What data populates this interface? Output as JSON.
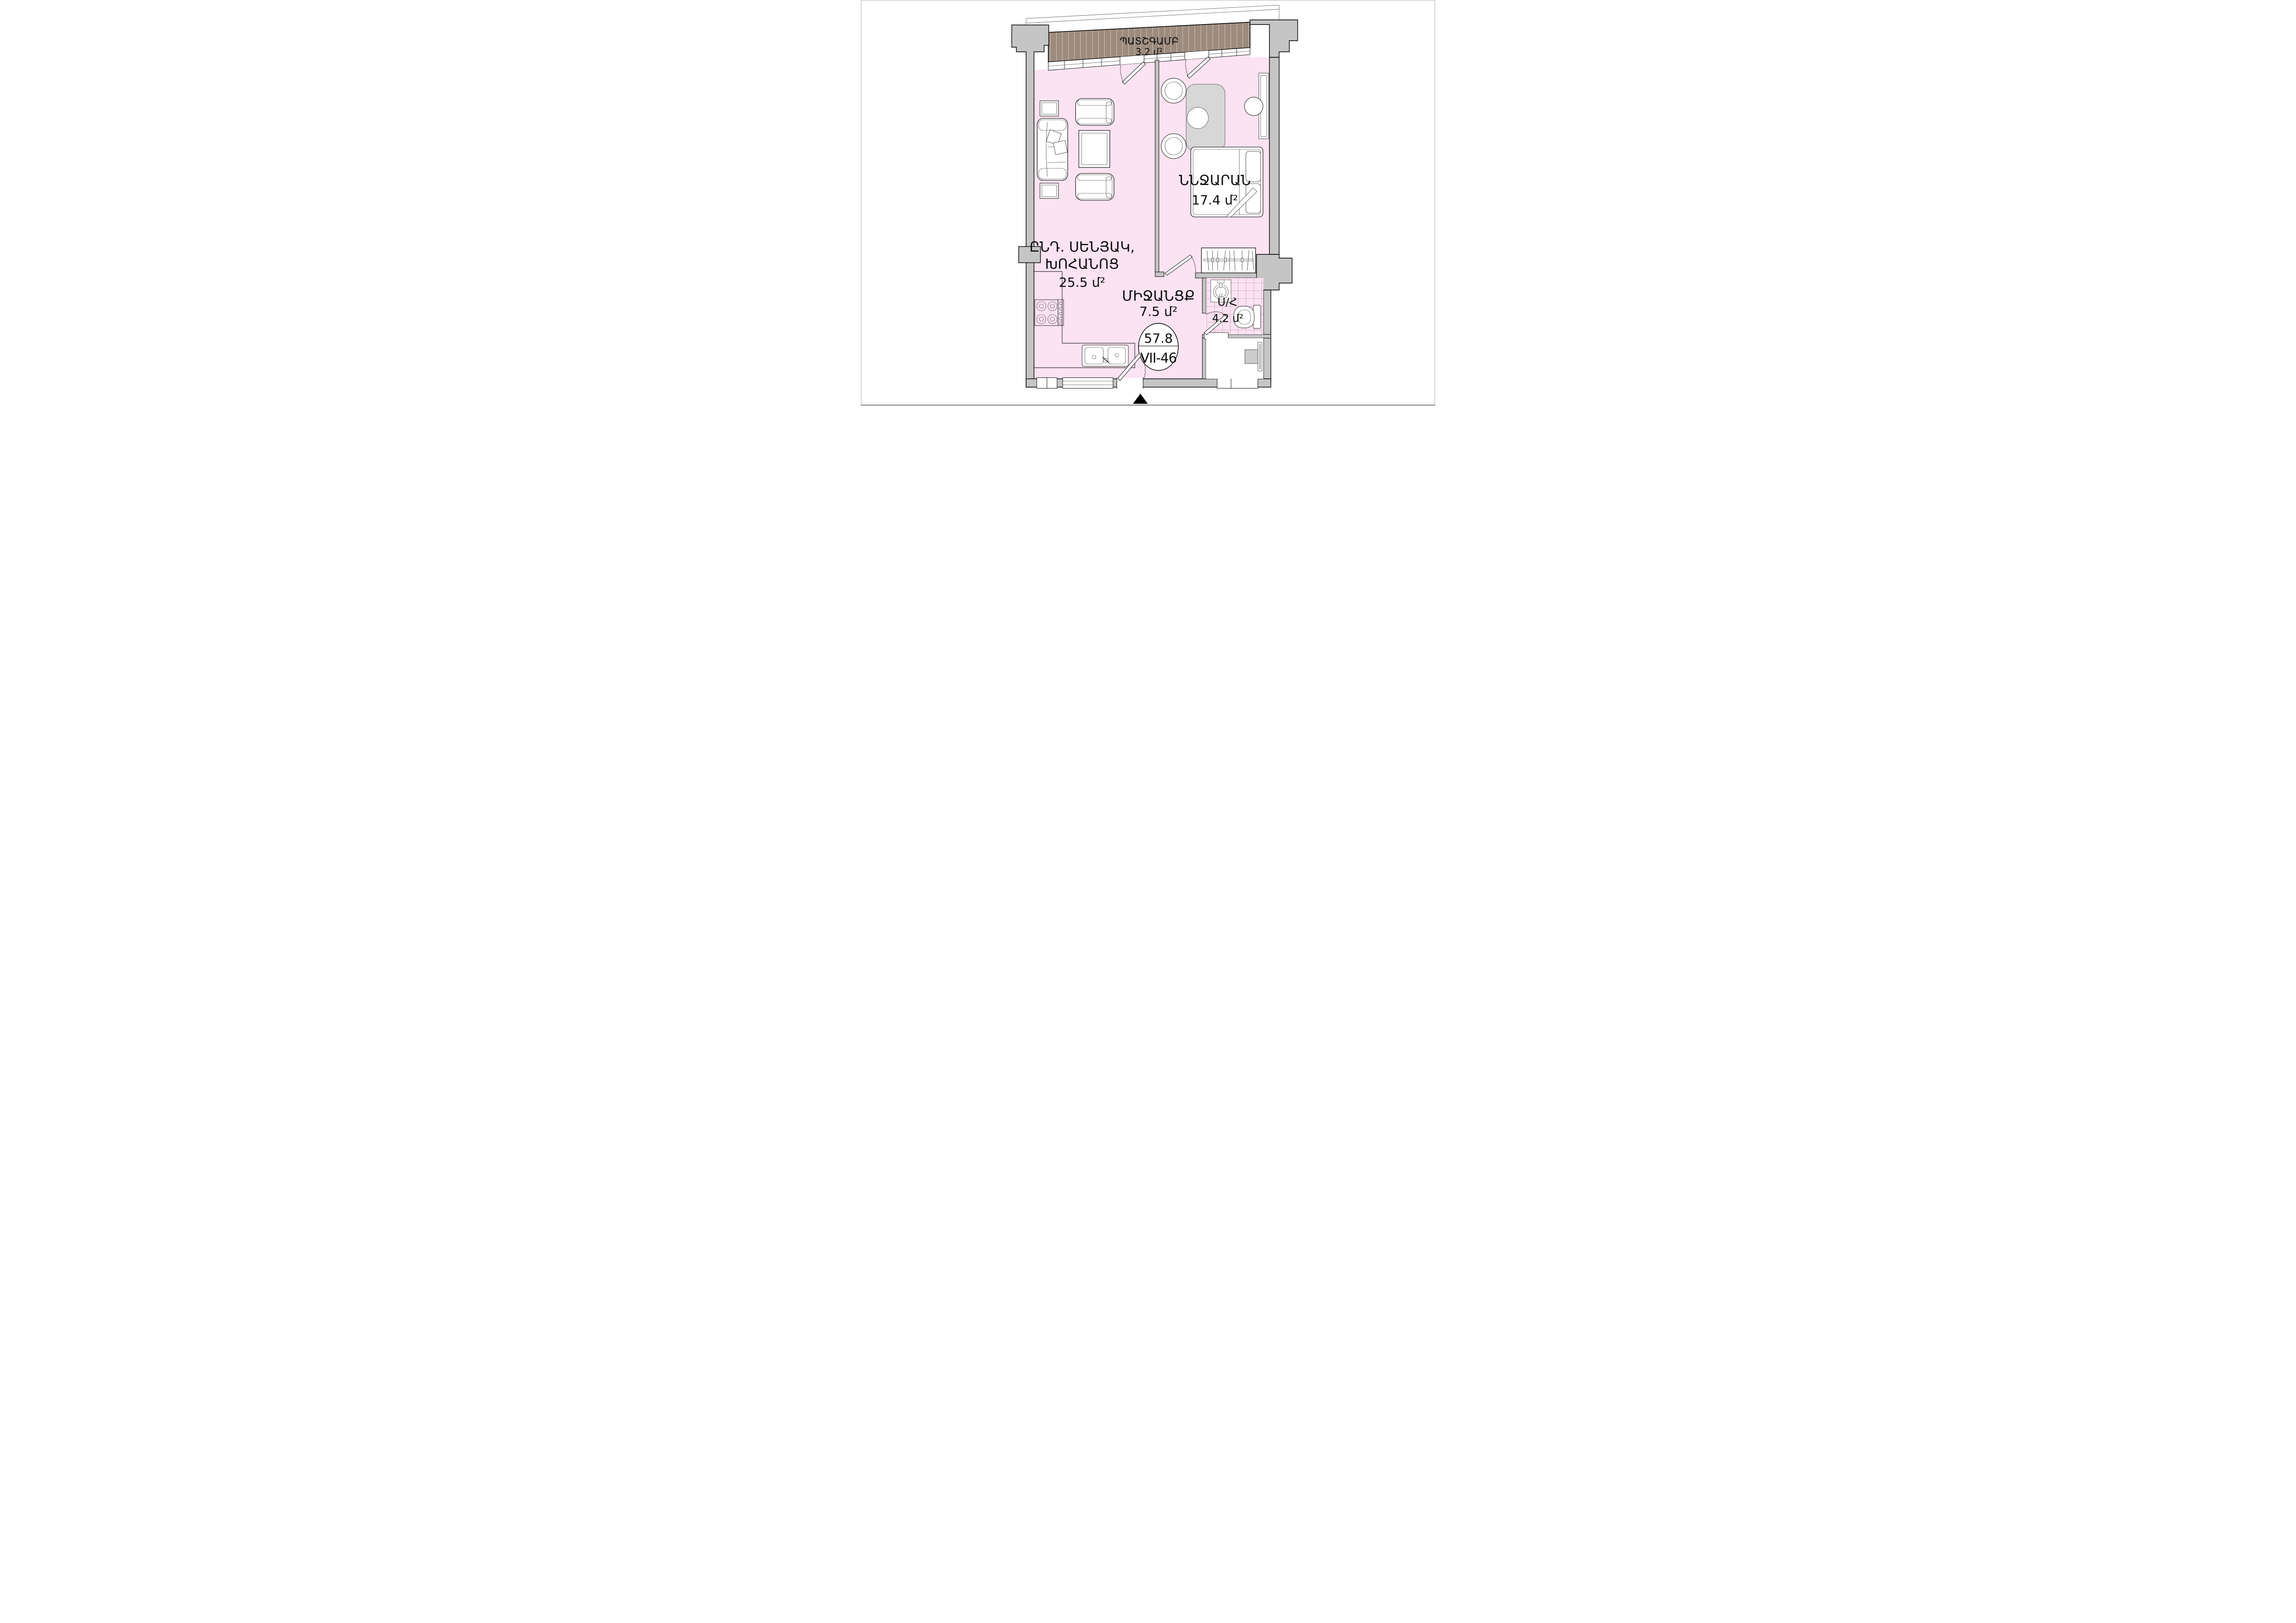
{
  "plan_title": "apartment-floor-plan",
  "labels": {
    "balcony": {
      "name": "ՊԱՏՇԳԱՄԲ",
      "area": "3.2 մ²"
    },
    "living": {
      "name_line1": "ԸՆԴ. ՍԵՆՅԱԿ,",
      "name_line2": "ԽՈՀԱՆՈՑ",
      "area": "25.5 մ²"
    },
    "bedroom": {
      "name": "ՆՆՋԱՐԱՆ",
      "area": "17.4 մ²"
    },
    "corridor": {
      "name": "ՄԻՋԱՆՑՔ",
      "area": "7.5 մ²"
    },
    "bathroom": {
      "name": "Ս/Հ",
      "area": "4.2 մ²"
    }
  },
  "badge": {
    "total_area": "57.8",
    "unit_number": "VII-46"
  },
  "colors": {
    "floor_pink": "#fbe3f2",
    "wall_gray": "#c5c5c5",
    "balcony_deck_brown": "#9d8b7e",
    "deck_stripe": "#cbc0b4",
    "tile_line": "#b688a3",
    "outline_black": "#000000"
  }
}
